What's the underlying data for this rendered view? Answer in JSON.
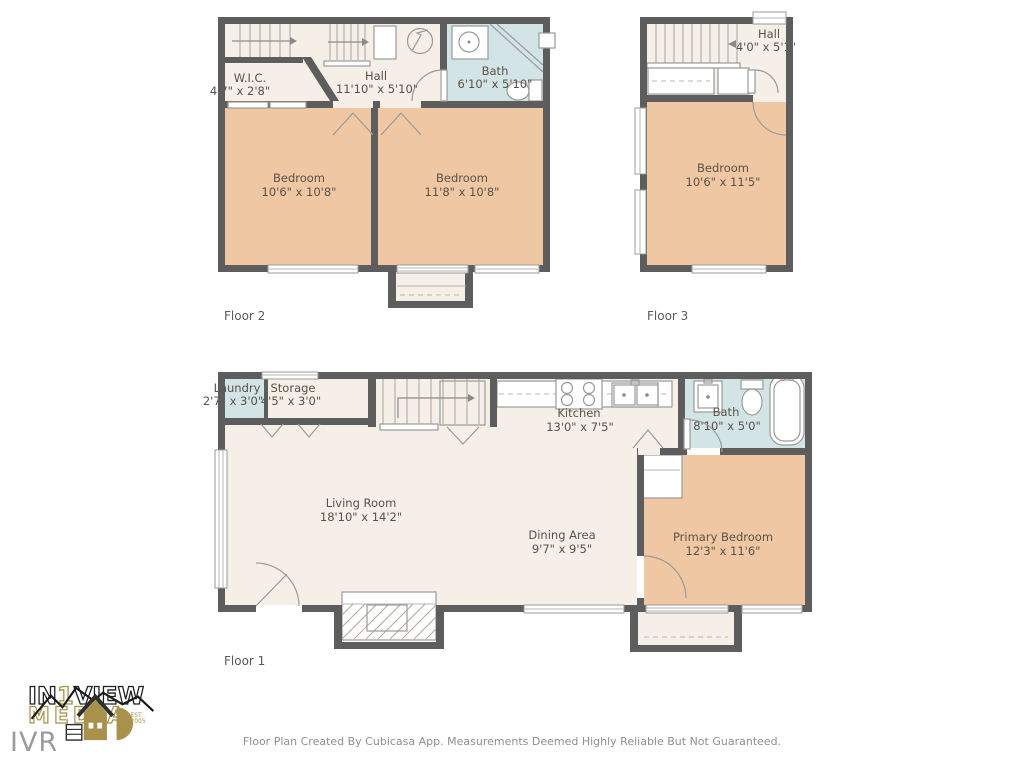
{
  "document": {
    "background": "#ffffff"
  },
  "colors": {
    "wall": "#5d5d5d",
    "room_default": "#f5efe7",
    "room_bedroom": "#efc8a3",
    "room_wet": "#d2e4e6",
    "logo_gold": "#a8914a",
    "label_text": "#5a5146"
  },
  "floors": {
    "floor1": {
      "label": "Floor 1"
    },
    "floor2": {
      "label": "Floor 2"
    },
    "floor3": {
      "label": "Floor 3"
    }
  },
  "rooms": {
    "f2_wic": {
      "name": "W.I.C.",
      "dims": "4'7\" x 2'8\""
    },
    "f2_hall": {
      "name": "Hall",
      "dims": "11'10\" x 5'10\""
    },
    "f2_bath": {
      "name": "Bath",
      "dims": "6'10\" x 5'10\""
    },
    "f2_bedroom_left": {
      "name": "Bedroom",
      "dims": "10'6\" x 10'8\""
    },
    "f2_bedroom_right": {
      "name": "Bedroom",
      "dims": "11'8\" x 10'8\""
    },
    "f3_hall": {
      "name": "Hall",
      "dims": "4'0\" x 5'1\""
    },
    "f3_bedroom": {
      "name": "Bedroom",
      "dims": "10'6\" x 11'5\""
    },
    "f1_laundry": {
      "name": "Laundry",
      "dims": "2'7\" x 3'0\""
    },
    "f1_storage": {
      "name": "Storage",
      "dims": "4'5\" x 3'0\""
    },
    "f1_kitchen": {
      "name": "Kitchen",
      "dims": "13'0\" x 7'5\""
    },
    "f1_bath": {
      "name": "Bath",
      "dims": "8'10\" x 5'0\""
    },
    "f1_living": {
      "name": "Living Room",
      "dims": "18'10\" x 14'2\""
    },
    "f1_dining": {
      "name": "Dining Area",
      "dims": "9'7\" x 9'5\""
    },
    "f1_primary": {
      "name": "Primary Bedroom",
      "dims": "12'3\" x 11'6\""
    }
  },
  "branding": {
    "brand_prefix": "IN",
    "brand_number": "1",
    "brand_suffix": "VIEW",
    "brand_word": "MEDIA",
    "est_top": "EST.",
    "est_bottom": "2005",
    "watermark": "IVR"
  },
  "footer": {
    "disclaimer": "Floor Plan Created By Cubicasa App. Measurements Deemed Highly Reliable But Not Guaranteed."
  }
}
